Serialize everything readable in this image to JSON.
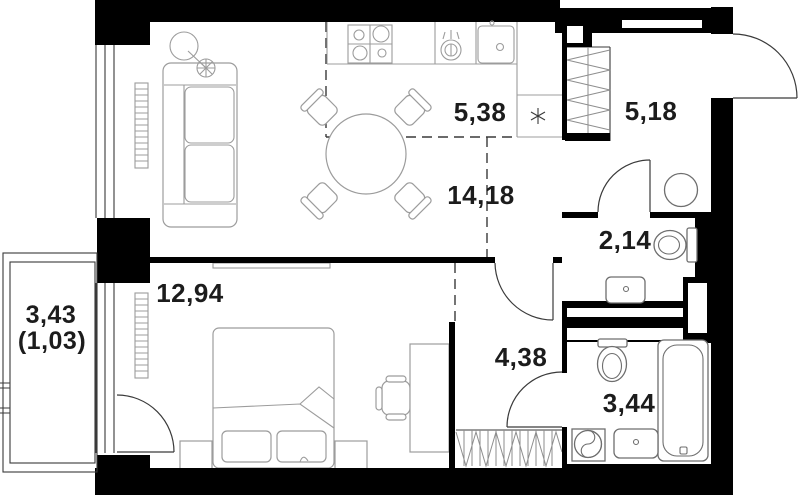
{
  "plan": {
    "rooms": [
      {
        "name": "kitchen",
        "area_label": "5,38"
      },
      {
        "name": "entrance-hall",
        "area_label": "5,18"
      },
      {
        "name": "living-room",
        "area_label": "14,18"
      },
      {
        "name": "toilet",
        "area_label": "2,14"
      },
      {
        "name": "bedroom",
        "area_label": "12,94"
      },
      {
        "name": "hallway",
        "area_label": "4,38"
      },
      {
        "name": "bathroom",
        "area_label": "3,44"
      },
      {
        "name": "balcony",
        "area_label": "3,43",
        "area_label_secondary": "(1,03)"
      }
    ],
    "icons": {
      "fridge_symbol": "six-spoke-asterisk"
    },
    "colors": {
      "wall": "#000000",
      "furniture_line": "#9c9c9c",
      "fixture_line": "#6e6e6e",
      "structure_line": "#3a3a3a",
      "text": "#1c1c1c",
      "background": "#ffffff"
    }
  }
}
